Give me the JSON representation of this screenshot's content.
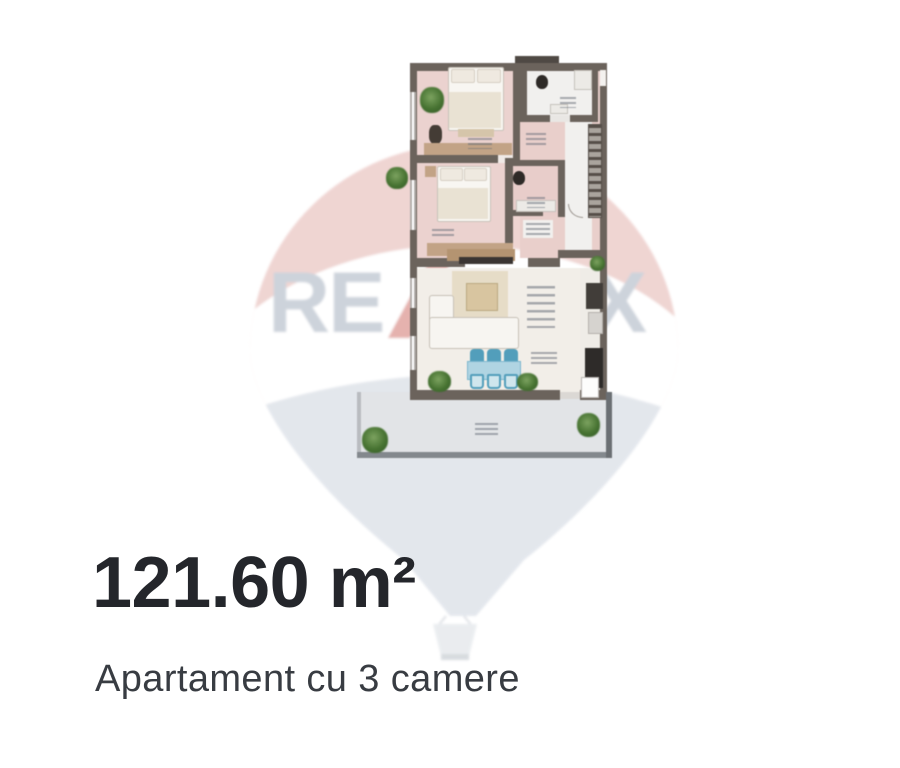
{
  "listing": {
    "area_value": "121.60 m²",
    "title": "Apartament cu 3 camere"
  },
  "watermark": {
    "brand": "RE/MAX",
    "re": "RE",
    "slash": "/",
    "max": "MAX",
    "colors": {
      "balloon_top": "#efd3d0",
      "balloon_band": "#ffffff",
      "balloon_bottom": "#e2e6ec",
      "letters": "#cbd1da",
      "slash": "#e4aeaa"
    }
  },
  "floor_plan": {
    "labels_illegible": true,
    "wall_color": "#6b635c",
    "rooms": [
      {
        "id": "bedroom-1",
        "floor": "#ecd2cf"
      },
      {
        "id": "bathroom-1",
        "floor": "#f1f0ee"
      },
      {
        "id": "entry-hall",
        "floor": "#eacfcb"
      },
      {
        "id": "bedroom-2",
        "floor": "#ecd2cf"
      },
      {
        "id": "bathroom-2",
        "floor": "#e9cdca"
      },
      {
        "id": "living-dining",
        "floor": "#f2eee8"
      },
      {
        "id": "kitchen",
        "floor": "#efece7"
      },
      {
        "id": "terrace",
        "floor": "#e2e4e7"
      }
    ],
    "furniture": [
      "double-bed-1",
      "double-bed-2",
      "wardrobe",
      "dresser",
      "desk",
      "tv-console",
      "tv",
      "rug",
      "coffee-table",
      "corner-sofa",
      "dining-table",
      "dining-chairs-x6",
      "toilet-1",
      "toilet-2",
      "vanity",
      "shower",
      "kitchen-counters",
      "terrace-door",
      "plants-x8"
    ],
    "accents": {
      "chair_blue": "#4f9fbd",
      "plant_green": "#45742f",
      "wood": "#c3a384"
    }
  },
  "caption_colors": {
    "area": "#24262b",
    "title": "#383c42"
  }
}
